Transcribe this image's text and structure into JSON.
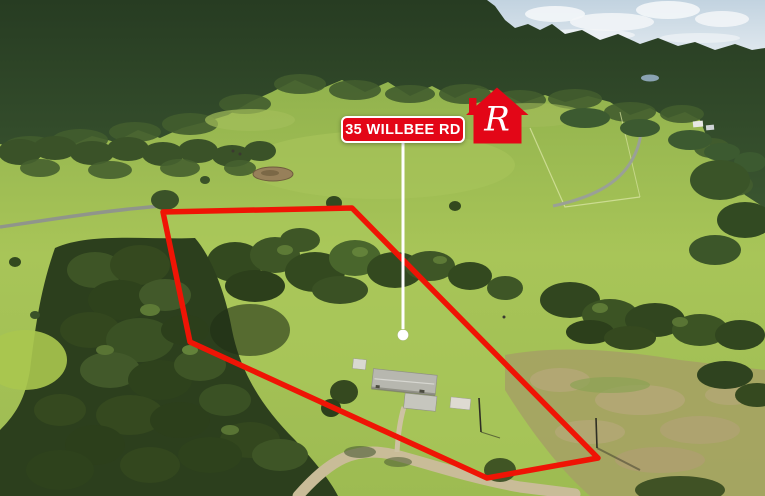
{
  "scene": {
    "description": "Aerial drone photograph of a rural acreage property among forested hills and green paddocks, with a farmhouse, sheds, gravel driveway, dam, dirt roads and a dry mown field",
    "width_px": 765,
    "height_px": 496
  },
  "overlay": {
    "address_label": "35 WILLBEE RD",
    "logo_letter": "R",
    "colors": {
      "brand_red": "#e30617",
      "boundary_red": "#ef1405",
      "label_text": "#ffffff",
      "pointer_white": "#ffffff"
    }
  },
  "boundary": {
    "points": "163,212 352,208 598,458 487,478 190,342"
  },
  "pointer": {
    "x1": "403",
    "y1": "142",
    "x2": "403",
    "y2": "329",
    "dot_cx": "403",
    "dot_cy": "335",
    "dot_r": "5.5"
  }
}
